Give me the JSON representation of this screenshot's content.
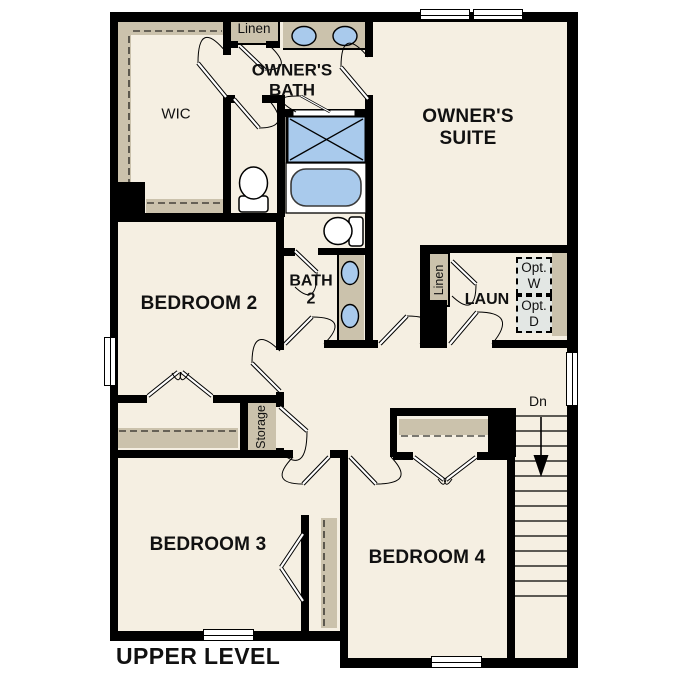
{
  "plan_title": "UPPER LEVEL",
  "rooms": {
    "wic": {
      "label": "WIC"
    },
    "owners_bath": {
      "line1": "OWNER'S",
      "line2": "BATH"
    },
    "owners_suite": {
      "line1": "OWNER'S",
      "line2": "SUITE"
    },
    "bedroom2": {
      "label": "BEDROOM 2"
    },
    "bath2": {
      "line1": "BATH",
      "line2": "2"
    },
    "laundry": {
      "label": "LAUN"
    },
    "bedroom3": {
      "label": "BEDROOM 3"
    },
    "bedroom4": {
      "label": "BEDROOM 4"
    }
  },
  "closets": {
    "linen_upper": {
      "label": "Linen"
    },
    "linen_laundry": {
      "label": "Linen"
    },
    "storage": {
      "label": "Storage"
    }
  },
  "optional_appliances": {
    "washer": {
      "line1": "Opt.",
      "line2": "W"
    },
    "dryer": {
      "line1": "Opt.",
      "line2": "D"
    }
  },
  "stairs": {
    "direction_label": "Dn"
  },
  "colors": {
    "floor": "#F5EFE2",
    "wall": "#000000",
    "closet_shelf": "#CBC2AC",
    "fixture_blue": "#A9CAEC",
    "appliance_gray": "#E3E7E4",
    "background": "#FFFFFF"
  }
}
